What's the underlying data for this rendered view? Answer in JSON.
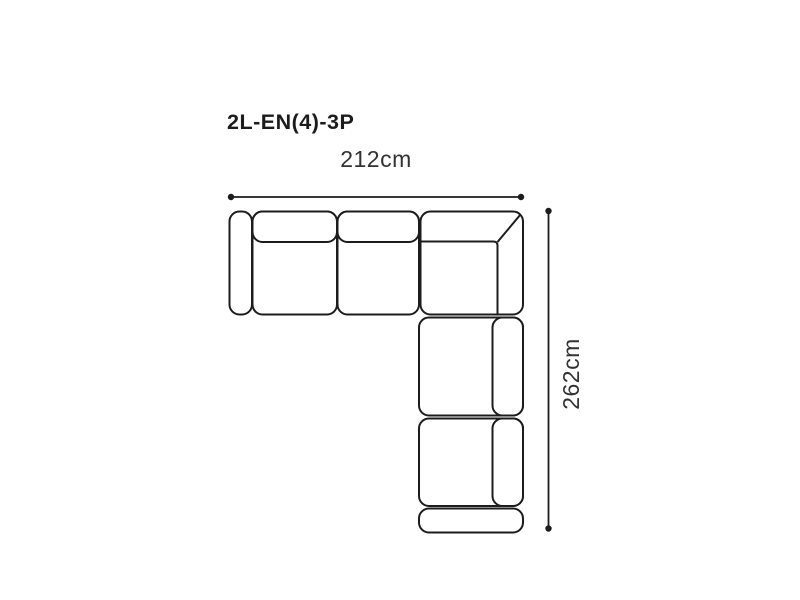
{
  "diagram": {
    "title": "2L-EN(4)-3P",
    "width_label": "212cm",
    "height_label": "262cm",
    "colors": {
      "background": "#ffffff",
      "line": "#1c1c1c",
      "title_text": "#1c1c1c",
      "dimension_text": "#323232"
    },
    "sofa": {
      "type": "corner-sectional-sofa-top-view",
      "parts": [
        "left-armrest",
        "seat-1",
        "seat-1-back-cushion",
        "seat-2",
        "seat-2-back-cushion",
        "corner-unit",
        "chaise-seat-1",
        "chaise-seat-1-back-cushion",
        "chaise-seat-2",
        "chaise-seat-2-back-cushion",
        "bottom-armrest"
      ]
    }
  }
}
